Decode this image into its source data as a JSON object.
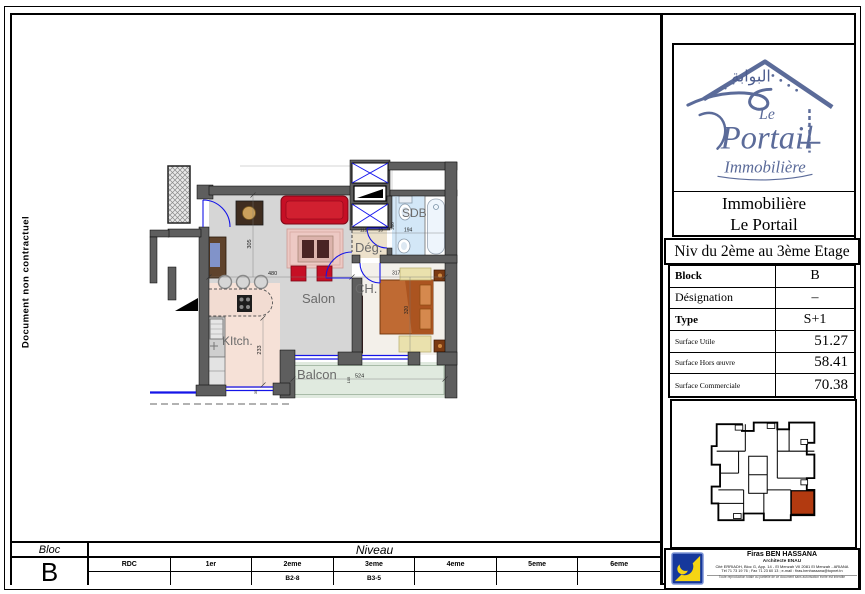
{
  "page": {
    "watermark": "Document non contractuel"
  },
  "plan": {
    "rooms": {
      "salon": "Salon",
      "kitchen": "KItch.",
      "balcony": "Balcon",
      "bedroom": "CH.",
      "bathroom": "SDB",
      "hallway": "Dég."
    },
    "dims": {
      "salon_width": "480",
      "salon_height": "305",
      "kitchen_height": "233",
      "kitchen_offset": "35",
      "balcony_width": "524",
      "balcony_height": "105",
      "bedroom_width": "317",
      "bedroom_height": "320",
      "bathroom_width": "194",
      "bathroom_height": "200",
      "hallway_width": "115",
      "hallway_gap": "10"
    }
  },
  "brand": {
    "arabic": "البوابة",
    "script_le": "Le",
    "script_name": "Portail",
    "script_sub": "Immobilière",
    "name_line1": "Immobilière",
    "name_line2": "Le Portail",
    "accent_color": "#5b6b99"
  },
  "title_block": {
    "level_title": "Niv du 2ème au 3ème Etage",
    "rows": [
      {
        "label": "Block",
        "value": "B"
      },
      {
        "label": "Désignation",
        "value": "–"
      },
      {
        "label": "Type",
        "value": "S+1"
      },
      {
        "label": "Surface Utile",
        "value": "51.27"
      },
      {
        "label": "Surface Hors œuvre",
        "value": "58.41"
      },
      {
        "label": "Surface Commerciale",
        "value": "70.38"
      }
    ]
  },
  "architect": {
    "name": "Firas BEN HASSANA",
    "title": "Architecte ENAU",
    "address": "Cité ERRIADH, Bloc G, App. 14 - El Menzah VII 2081 El Menzah - ARIANA",
    "contact": "Tél 71 73 19 76 ; Fax 71 23 60 13 ; e-mail : firas.benhassana@topnet.tn",
    "note": "Toute reproduction totale ou partielle de ce document sans autorisation écrite est interdite"
  },
  "level_bar": {
    "bloc_label": "Bloc",
    "bloc_value": "B",
    "niveau_label": "Niveau",
    "levels": [
      "RDC",
      "1er",
      "2eme",
      "3eme",
      "4eme",
      "5eme",
      "6eme"
    ],
    "units": [
      "",
      "",
      "B2-8",
      "B3-5",
      "",
      "",
      ""
    ]
  }
}
